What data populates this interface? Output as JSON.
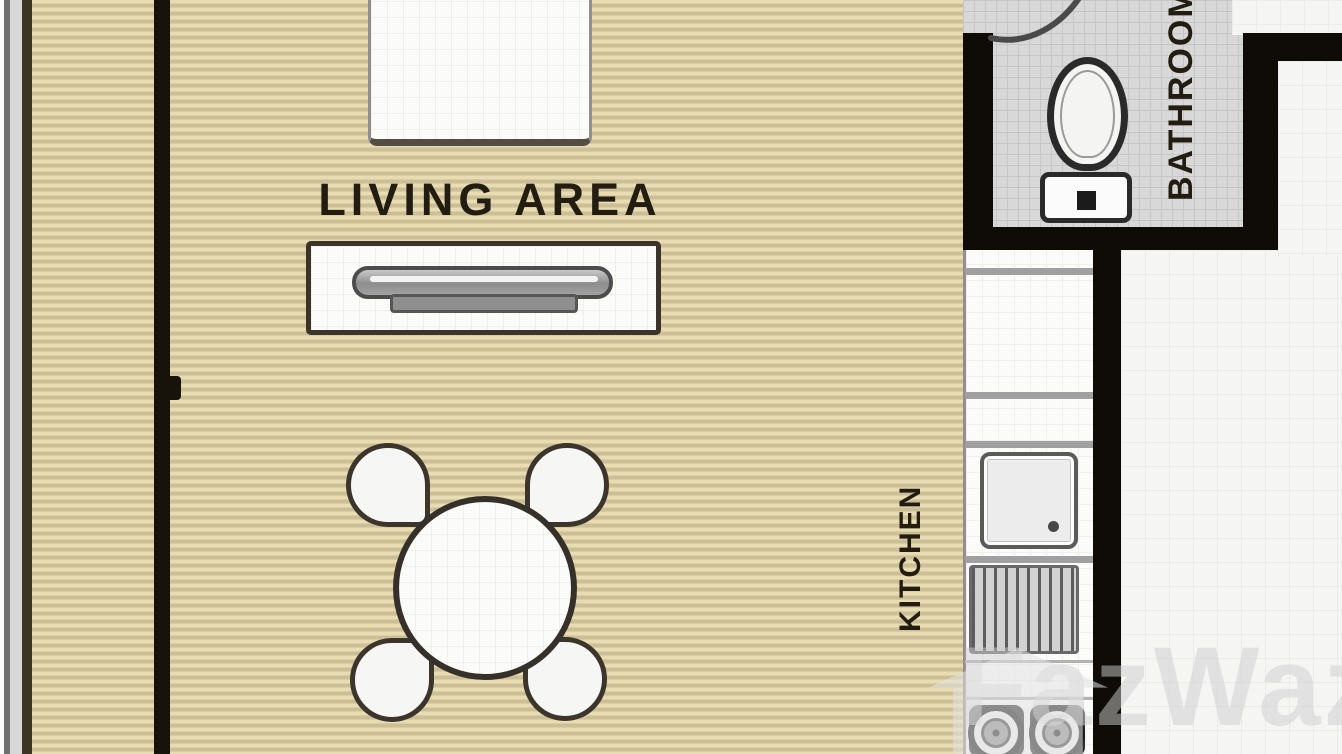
{
  "title": "studio apartment floor plan",
  "rooms": {
    "living_area": {
      "label": "LIVING AREA"
    },
    "kitchen": {
      "label": "KITCHEN"
    },
    "bathroom": {
      "label": "BATHROOM"
    }
  },
  "watermark": {
    "text": "FazWaz"
  },
  "furniture_icons": [
    "sofa-icon",
    "tv-console-icon",
    "tv-icon",
    "dining-table-icon",
    "dining-chair-icon",
    "toilet-icon",
    "sink-icon",
    "drying-rack-icon",
    "stove-burner-icon",
    "door-swing-icon"
  ],
  "colors": {
    "floor_stripe_light": "#e8dcb2",
    "floor_stripe_dark": "#ccbe97",
    "wall_black": "#0f0c07",
    "balcony_edge_brown": "#3e3424",
    "bathroom_tile": "#d8d8d8",
    "white_room_floor": "#f5f5f4",
    "furniture_outline": "#3b342a",
    "label_text": "#221c11",
    "watermark_gray": "#cdcdcd"
  }
}
